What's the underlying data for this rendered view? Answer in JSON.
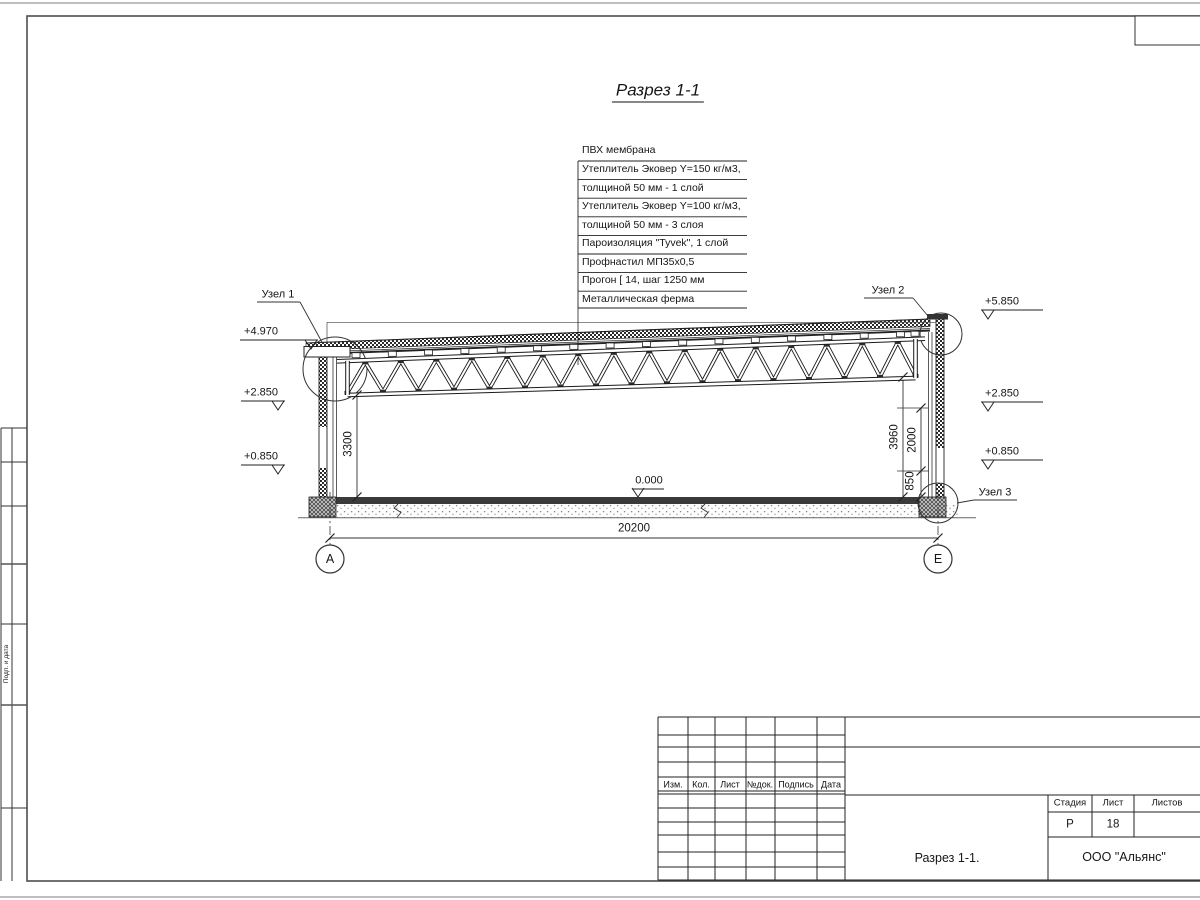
{
  "drawing": {
    "title": "Разрез 1-1",
    "roof_layers": [
      "ПВХ мембрана",
      "Утеплитель Эковер Y=150 кг/м3,",
      "толщиной 50 мм - 1 слой",
      "Утеплитель Эковер Y=100 кг/м3,",
      "толщиной 50 мм - 3 слоя",
      "Пароизоляция \"Tyvek\", 1 слой",
      "Профнастил МП35х0,5",
      "Прогон [ 14, шаг 1250 мм",
      "Металлическая ферма"
    ],
    "node_labels": [
      "Узел 1",
      "Узел 2",
      "Узел 3"
    ],
    "levels_left": [
      "+4.970",
      "+2.850",
      "+0.850"
    ],
    "levels_right": [
      "+5.850",
      "+2.850",
      "+0.850"
    ],
    "level_floor": "0.000",
    "dim_span": "20200",
    "dim_left_height": "3300",
    "dims_right": [
      "3960",
      "2000",
      "850"
    ],
    "axis_left": "А",
    "axis_right": "Е"
  },
  "title_block": {
    "rev_headers": [
      "Изм.",
      "Кол.",
      "Лист",
      "№док.",
      "Подпись",
      "Дата"
    ],
    "stage_label": "Стадия",
    "sheet_label": "Лист",
    "sheets_label": "Листов",
    "stage_value": "Р",
    "sheet_value": "18",
    "sheets_value": "",
    "caption": "Разрез 1-1.",
    "company": "ООО \"Альянс\""
  },
  "margin": {
    "vertical_label": "Подп. и дата"
  },
  "colors": {
    "line": "#222222",
    "frame": "#555555",
    "slab": "#3a3a3a"
  }
}
